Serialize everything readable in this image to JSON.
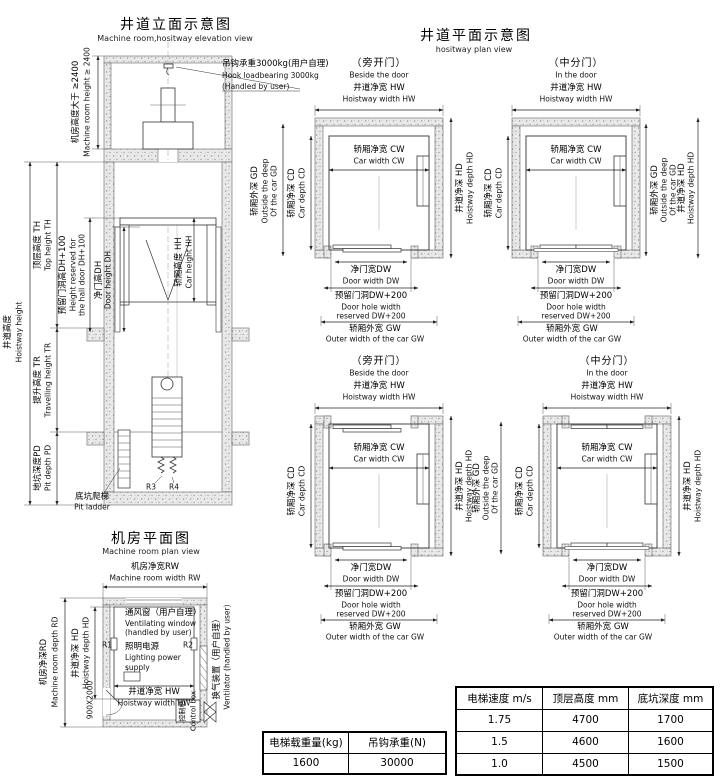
{
  "titles": {
    "elevation_cn": "井道立面示意图",
    "elevation_en": "Machine room,hositway elevation view",
    "plan_cn": "井道平面示意图",
    "plan_en": "hositway plan view",
    "machine_room_cn": "机房平面图",
    "machine_room_en": "Machine room plan view"
  },
  "elevation": {
    "hoistway_height_cn": "井道高度",
    "hoistway_height_en": "Hoistway height",
    "top_height_cn": "顶层高度 TH",
    "top_height_en": "Top height TH",
    "machine_room_height_cn": "机房高度大于 ≥2400",
    "machine_room_height_en": "Machine room height ≥ 2400",
    "hook_line1": "吊钩承重3000kg(用户自理)",
    "hook_line2": "Hook loadbearing 3000kg",
    "hook_line3": "(Handled by user)",
    "door_hole_height_cn": "预留门洞高DH+100",
    "door_hole_height_en1": "Height reserved for",
    "door_hole_height_en2": "the hall door DH+100",
    "door_height_cn": "净门高DH",
    "door_height_en": "Door height DH",
    "car_height_cn": "轿厢高度 HH",
    "car_height_en": "Car height HH",
    "travelling_height_cn": "提升高度 TR",
    "travelling_height_en": "Travelling height TR",
    "pit_depth_cn": "地坑深度PD",
    "pit_depth_en": "Pit depth PD",
    "pit_ladder_cn": "底坑爬梯",
    "pit_ladder_en": "Pit ladder",
    "r3": "R3",
    "r4": "R4"
  },
  "plan_section": {
    "variants": {
      "side": {
        "cn": "（旁开门）",
        "en": "Beside the door"
      },
      "center": {
        "cn": "（中分门）",
        "en": "In the door"
      }
    },
    "shared": {
      "hoistway_width_cn": "井道净宽 HW",
      "hoistway_width_en": "Hoistway width HW",
      "car_width_cn": "轿厢净宽 CW",
      "car_width_en": "Car width CW",
      "car_depth_cn": "轿厢净深 CD",
      "car_depth_en": "Car depth CD",
      "car_outer_depth_cn": "轿厢外深 GD",
      "car_outer_depth_en1": "Outside the deep",
      "car_outer_depth_en2": "Of the car GD",
      "hoistway_depth_cn": "井道净深 HD",
      "hoistway_depth_en": "Hoistway depth HD",
      "door_width_cn": "净门宽DW",
      "door_width_en": "Door width DW",
      "door_hole_cn": "预留门洞DW+200",
      "door_hole_en1": "Door hole width",
      "door_hole_en2": "reserved DW+200",
      "car_outer_width_cn": "轿厢外宽 GW",
      "car_outer_width_en": "Outer width of the car GW"
    }
  },
  "machine_room": {
    "room_width_cn": "机房净宽RW",
    "room_width_en": "Machine room width RW",
    "vent_window_cn": "通风窗（用户自理）",
    "vent_window_en1": "Ventilating window",
    "vent_window_en2": "(handled by user)",
    "lighting_cn": "照明电源",
    "lighting_en1": "Lighting power",
    "lighting_en2": "supply",
    "r1": "R1",
    "r2": "R2",
    "hoistway_width_cn": "井道净宽 HW",
    "hoistway_width_en": "Hoistway width HW",
    "door_size": "900X2000",
    "control_cn": "控制柜",
    "control_en": "Control box",
    "room_depth_cn": "机房净深RD",
    "room_depth_en": "Machine room depth RD",
    "hoistway_depth_cn": "井道净深 HD",
    "hoistway_depth_en": "Hoistway depth HD",
    "ventilator_cn": "换气装置（用户自理）",
    "ventilator_en": "Ventilator (handled by user)"
  },
  "tables": {
    "load": {
      "headers": [
        "电梯载重量(kg)",
        "吊钩承重(N)"
      ],
      "rows": [
        [
          "1600",
          "30000"
        ]
      ]
    },
    "spec": {
      "headers": [
        "电梯速度 m/s",
        "顶层高度 mm",
        "底坑深度 mm"
      ],
      "rows": [
        [
          "1.75",
          "4700",
          "1700"
        ],
        [
          "1.5",
          "4600",
          "1600"
        ],
        [
          "1.0",
          "4500",
          "1500"
        ]
      ]
    }
  },
  "colors": {
    "line": "#333333",
    "wall_fill": "#e9e9e9",
    "text": "#000000"
  }
}
